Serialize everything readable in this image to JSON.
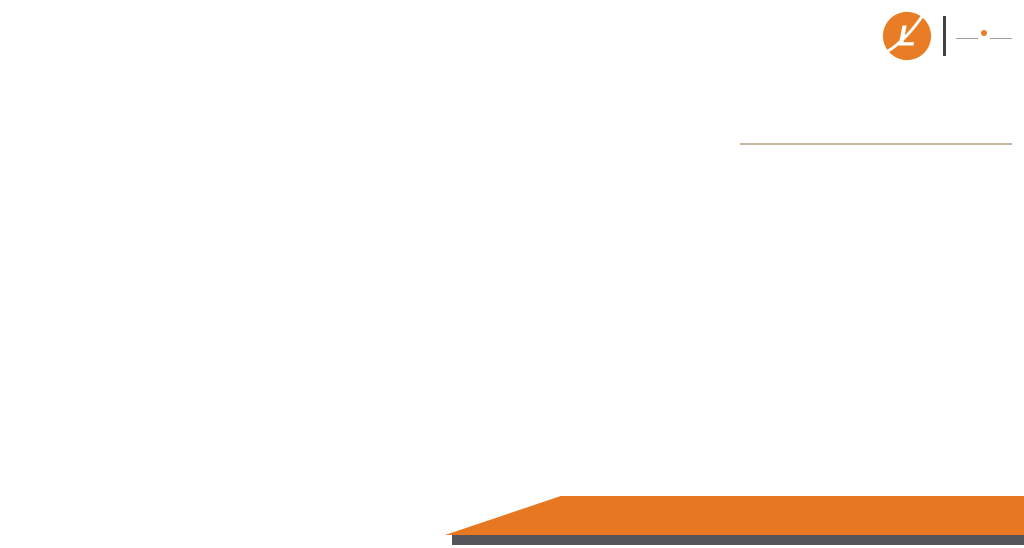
{
  "logo": {
    "mark_letter": "L",
    "brand_pre": "LAR",
    "brand_i": "I",
    "brand_post": "SA",
    "tagline": "REALTECH PVT LTD",
    "orange": "#e87d26",
    "dark": "#3e4347"
  },
  "info": {
    "title": "FLOOR PLAN",
    "subtitle": "4 BHK–APARTMENTS",
    "size_line": "SIZE-2812 SQ.FT. [261.2433 SQ.M.]",
    "floor_line": "TYPICAL FLOOR - B3, B4, B5 & B6 LEVEL"
  },
  "footer": {
    "phone": "8750 86 86 86",
    "divider": "|",
    "website": "www.LarisaRealtech.com"
  },
  "watermark": {
    "letter1": "L",
    "letter2": "R"
  },
  "plan": {
    "mirror_axis": 784,
    "colors": {
      "room": "#f6efd6",
      "wet": "#b7dde4",
      "lift": "#f0906a",
      "balcony": "#e9e1cb",
      "stair": "#f4eeda",
      "wall": "#262626",
      "stroke": "#4f4b43",
      "furniture": "#a7acb2",
      "furniture_stroke": "#60646a",
      "label": "#45453f"
    },
    "rooms": [
      {
        "id": "balcony-top-small",
        "label": "BALCONY",
        "t": "bal",
        "x": 95,
        "y": 33,
        "w": 80,
        "h": 58,
        "lx": 135,
        "ly": 50,
        "small": 1,
        "m": 1
      },
      {
        "id": "balcony-top-large",
        "label": "BALCONY",
        "t": "bal",
        "x": 200,
        "y": 31,
        "w": 175,
        "h": 62,
        "lx": 266,
        "ly": 57,
        "small": 1,
        "m": 1
      },
      {
        "id": "toilet-far",
        "label": "TOILET",
        "t": "wet",
        "x": 62,
        "y": 63,
        "w": 53,
        "h": 117,
        "lx": 88,
        "ly": 130,
        "small": 1,
        "m": 1
      },
      {
        "id": "dress-top",
        "label": "DRESS",
        "t": "dry",
        "x": 62,
        "y": 180,
        "w": 53,
        "h": 45,
        "lx": 88,
        "ly": 205,
        "small": 1,
        "m": 1
      },
      {
        "id": "bedroom-1",
        "label": "BED ROOM",
        "t": "dry",
        "x": 115,
        "y": 95,
        "w": 53,
        "h": 130,
        "lx": 141,
        "ly": 117,
        "m": 1
      },
      {
        "id": "toilet-mid",
        "label": "TOILET",
        "t": "wet",
        "x": 168,
        "y": 62,
        "w": 28,
        "h": 160,
        "lx": 182,
        "ly": 178,
        "small": 1,
        "m": 1
      },
      {
        "id": "bedroom-2",
        "label": "BED ROOM",
        "t": "dry",
        "x": 196,
        "y": 95,
        "w": 57,
        "h": 130,
        "lx": 222,
        "ly": 180,
        "m": 1
      },
      {
        "id": "dining",
        "label": "DINING",
        "t": "dry",
        "x": 253,
        "y": 95,
        "w": 34,
        "h": 130,
        "lx": 270,
        "ly": 198,
        "m": 1
      },
      {
        "id": "kitchen",
        "label": "KITCHEN",
        "t": "dry",
        "x": 287,
        "y": 95,
        "w": 43,
        "h": 130,
        "lx": 308,
        "ly": 163,
        "m": 1
      },
      {
        "id": "passage",
        "label": "PASSAGE",
        "t": "dry",
        "x": 115,
        "y": 225,
        "w": 195,
        "h": 35,
        "lx": 218,
        "ly": 244,
        "m": 1
      },
      {
        "id": "foyer",
        "label": "FOYER",
        "t": "dry",
        "x": 300,
        "y": 225,
        "w": 30,
        "h": 38,
        "lx": 315,
        "ly": 241,
        "small": 1,
        "m": 1
      },
      {
        "id": "master-bedroom",
        "label": "MASTER BEDROOM",
        "t": "dry",
        "x": 80,
        "y": 248,
        "w": 57,
        "h": 140,
        "lx": 108,
        "ly": 284,
        "small": 1,
        "m": 1
      },
      {
        "id": "dress-bottom",
        "label": "DRESS",
        "t": "dry",
        "x": 140,
        "y": 268,
        "w": 32,
        "h": 40,
        "lx": 156,
        "ly": 290,
        "small": 1,
        "m": 1
      },
      {
        "id": "toilet-bottom",
        "label": "TOILET",
        "t": "wet",
        "x": 139,
        "y": 308,
        "w": 29,
        "h": 95,
        "lx": 154,
        "ly": 355,
        "small": 1,
        "m": 1
      },
      {
        "id": "bedroom-3",
        "label": "BED ROOM",
        "t": "dry",
        "x": 172,
        "y": 263,
        "w": 55,
        "h": 132,
        "lx": 200,
        "ly": 304,
        "m": 1
      },
      {
        "id": "living",
        "label": "LIVING",
        "t": "dry",
        "x": 227,
        "y": 260,
        "w": 78,
        "h": 138,
        "lx": 273,
        "ly": 313,
        "m": 1
      },
      {
        "id": "balcony-corner-v",
        "label": "",
        "t": "bal",
        "x": 41,
        "y": 300,
        "w": 39,
        "h": 147,
        "m": 1
      },
      {
        "id": "balcony-corner",
        "label": "BALCONY",
        "t": "bal",
        "x": 41,
        "y": 390,
        "w": 97,
        "h": 57,
        "lx": 89,
        "ly": 421,
        "small": 1,
        "m": 1
      },
      {
        "id": "balcony-bottom-center",
        "label": "BALCONY",
        "t": "bal",
        "x": 172,
        "y": 398,
        "w": 157,
        "h": 42,
        "lx": 276,
        "ly": 411,
        "small": 1,
        "m": 1
      },
      {
        "id": "utility",
        "label": "UTILITY",
        "t": "dry",
        "x": 325,
        "y": 150,
        "w": 44,
        "h": 55,
        "lx": 347,
        "ly": 181,
        "small": 1,
        "m": 1
      },
      {
        "id": "toilet-core-top",
        "label": "TOILET",
        "t": "wet",
        "x": 338,
        "y": 93,
        "w": 30,
        "h": 57,
        "lx": 353,
        "ly": 103,
        "small": 1,
        "m": 1
      },
      {
        "id": "powder-room",
        "label": "PD. RM",
        "t": "wet",
        "x": 305,
        "y": 285,
        "w": 24,
        "h": 58,
        "lx": 317,
        "ly": 312,
        "small": 1,
        "m": 1
      },
      {
        "id": "stair-bottom",
        "label": "",
        "t": "stair",
        "x": 330,
        "y": 335,
        "w": 44,
        "h": 118,
        "m": 1
      },
      {
        "id": "stair-top",
        "label": "",
        "t": "stairv",
        "x": 368,
        "y": 95,
        "w": 48,
        "h": 48,
        "m": 0
      },
      {
        "id": "lift-top",
        "label": "LIFT",
        "t": "lift",
        "x": 374,
        "y": 152,
        "w": 42,
        "h": 50,
        "lx": 395,
        "ly": 180,
        "small": 1,
        "m": 0
      },
      {
        "id": "lobby",
        "label": "LOBBY",
        "t": "dry",
        "x": 330,
        "y": 208,
        "w": 130,
        "h": 62,
        "lx": 393,
        "ly": 243,
        "m": 0
      },
      {
        "id": "mv-shaft",
        "label": "",
        "t": "dry",
        "x": 328,
        "y": 270,
        "w": 34,
        "h": 30,
        "m": 0
      },
      {
        "id": "fhc-shaft",
        "label": "",
        "t": "dry",
        "x": 426,
        "y": 270,
        "w": 30,
        "h": 30,
        "m": 0
      },
      {
        "id": "lift-bottom",
        "label": "LIFT",
        "t": "lift",
        "x": 375,
        "y": 285,
        "w": 40,
        "h": 88,
        "lx": 395,
        "ly": 332,
        "small": 1,
        "m": 0
      }
    ],
    "tiny_labels": [
      [
        "UP",
        337,
        349
      ],
      [
        "DN",
        363,
        355
      ],
      [
        "DN",
        421,
        341
      ],
      [
        "UP",
        448,
        341
      ],
      [
        "MV",
        344,
        281
      ],
      [
        "200X300",
        344,
        288
      ],
      [
        "FHC",
        441,
        285
      ]
    ],
    "furniture": {
      "beds": [
        [
          119,
          126,
          42,
          90
        ],
        [
          202,
          110,
          38,
          66
        ],
        [
          180,
          298,
          44,
          66
        ],
        [
          98,
          296,
          36,
          74
        ]
      ],
      "diamonds": [
        [
          237,
          196,
          20
        ],
        [
          205,
          278,
          18
        ],
        [
          91,
          263,
          15
        ]
      ],
      "tables": [
        [
          259,
          121,
          25,
          62
        ]
      ],
      "gray_rects": [
        [
          229,
          272,
          14,
          64
        ],
        [
          241,
          342,
          17,
          17
        ],
        [
          314,
          99,
          15,
          54
        ],
        [
          289,
          201,
          38,
          12
        ]
      ],
      "dark_rects": [
        [
          291,
          97,
          17,
          12
        ]
      ],
      "windows": [
        [
          321,
          37,
          31,
          16
        ],
        [
          45,
          302,
          21,
          12
        ]
      ],
      "xboxes": [
        [
          66,
          68,
          45,
          56,
          ""
        ],
        [
          170,
          64,
          25,
          62,
          ""
        ],
        [
          341,
          106,
          25,
          40,
          ""
        ],
        [
          141,
          362,
          26,
          38,
          ""
        ],
        [
          123,
          407,
          28,
          27,
          "#ffffff"
        ],
        [
          342,
          438,
          26,
          28,
          "#f4eeda"
        ]
      ],
      "wc": [
        [
          76,
          158
        ],
        [
          182,
          203
        ],
        [
          152,
          330
        ],
        [
          316,
          328
        ],
        [
          352,
          126
        ]
      ],
      "arcs": [
        [
          150,
          225,
          17,
          180
        ],
        [
          218,
          225,
          15,
          180
        ],
        [
          137,
          263,
          15,
          90
        ],
        [
          176,
          263,
          14,
          0
        ],
        [
          300,
          228,
          14,
          0
        ],
        [
          262,
          398,
          12,
          180
        ],
        [
          330,
          95,
          13,
          90
        ]
      ]
    },
    "walls": [
      [
        62,
        63,
        115,
        63
      ],
      [
        62,
        63,
        62,
        180
      ],
      [
        95,
        33,
        175,
        33
      ],
      [
        95,
        33,
        95,
        91
      ],
      [
        175,
        33,
        175,
        91
      ],
      [
        200,
        31,
        375,
        31
      ],
      [
        200,
        31,
        200,
        93
      ],
      [
        95,
        93,
        338,
        93
      ],
      [
        80,
        248,
        80,
        390
      ],
      [
        41,
        300,
        41,
        447
      ],
      [
        41,
        447,
        138,
        447
      ],
      [
        41,
        300,
        80,
        300
      ],
      [
        172,
        440,
        329,
        440
      ]
    ],
    "wall_rects": [
      [
        378,
        62,
        9,
        31
      ],
      [
        338,
        450,
        38,
        13
      ]
    ],
    "columns": [
      [
        107,
        88
      ],
      [
        160,
        88
      ],
      [
        192,
        88
      ],
      [
        249,
        88
      ],
      [
        283,
        88
      ],
      [
        326,
        88
      ],
      [
        364,
        88
      ],
      [
        107,
        218
      ],
      [
        160,
        218
      ],
      [
        192,
        218
      ],
      [
        283,
        218
      ],
      [
        306,
        218
      ],
      [
        76,
        244
      ],
      [
        130,
        244
      ],
      [
        168,
        256
      ],
      [
        220,
        256
      ],
      [
        131,
        300
      ],
      [
        131,
        385
      ],
      [
        168,
        388
      ],
      [
        220,
        390
      ],
      [
        303,
        282
      ],
      [
        303,
        338
      ],
      [
        364,
        260
      ],
      [
        326,
        330
      ],
      [
        58,
        60
      ],
      [
        58,
        172
      ],
      [
        110,
        60
      ]
    ]
  }
}
